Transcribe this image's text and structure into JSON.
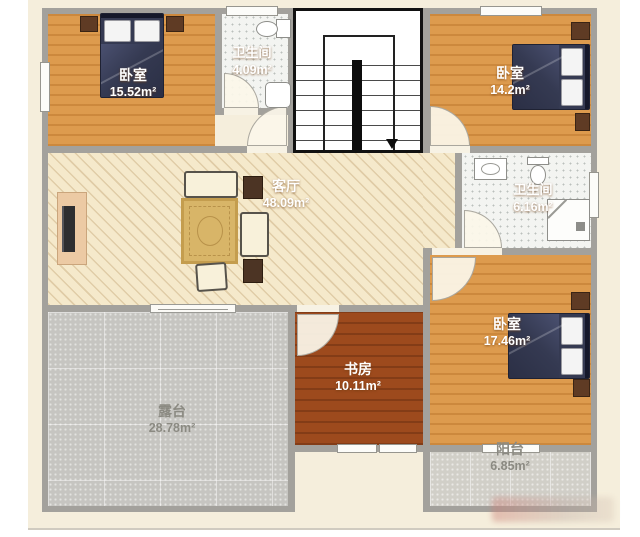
{
  "page": {
    "type": "apartment floor plan",
    "paper_color": "#f5eedc",
    "wall_color": "#a3a19c",
    "unit": "m²"
  },
  "plan": {
    "rooms": [
      {
        "id": "bedroom-top-left",
        "name": "卧室",
        "area": "15.52m²",
        "floor_color": "#dd9b4e",
        "furniture": [
          "double-bed",
          "nightstand",
          "nightstand"
        ]
      },
      {
        "id": "bathroom-top",
        "name": "卫生间",
        "area": "4.09m²",
        "floor_color": "#f3f4f1",
        "furniture": [
          "toilet",
          "bathtub"
        ]
      },
      {
        "id": "bedroom-top-right",
        "name": "卧室",
        "area": "14.2m²",
        "floor_color": "#dd9b4e",
        "furniture": [
          "double-bed",
          "nightstand",
          "nightstand"
        ]
      },
      {
        "id": "living-room",
        "name": "客厅",
        "area": "48.09m²",
        "floor_color": "#f5e9cb",
        "furniture": [
          "sofa",
          "loveseat",
          "armchair",
          "rug",
          "side-table",
          "side-table",
          "tv-cabinet"
        ]
      },
      {
        "id": "bathroom-right",
        "name": "卫生间",
        "area": "6.16m²",
        "floor_color": "#f3f4f1",
        "furniture": [
          "sink",
          "toilet",
          "shower"
        ]
      },
      {
        "id": "bedroom-bottom-right",
        "name": "卧室",
        "area": "17.46m²",
        "floor_color": "#dd9b4e",
        "furniture": [
          "double-bed",
          "nightstand",
          "nightstand"
        ]
      },
      {
        "id": "study",
        "name": "书房",
        "area": "10.11m²",
        "floor_color": "#9d4a1d",
        "furniture": []
      },
      {
        "id": "terrace",
        "name": "露台",
        "area": "28.78m²",
        "floor_color": "#c6c5c1",
        "furniture": []
      },
      {
        "id": "balcony",
        "name": "阳台",
        "area": "6.85m²",
        "floor_color": "#d1cfc8",
        "furniture": []
      }
    ],
    "stairs": {
      "arrow_direction": "down"
    },
    "bed_color": "#353a52",
    "study_floor_color": "#9d4a1d"
  }
}
